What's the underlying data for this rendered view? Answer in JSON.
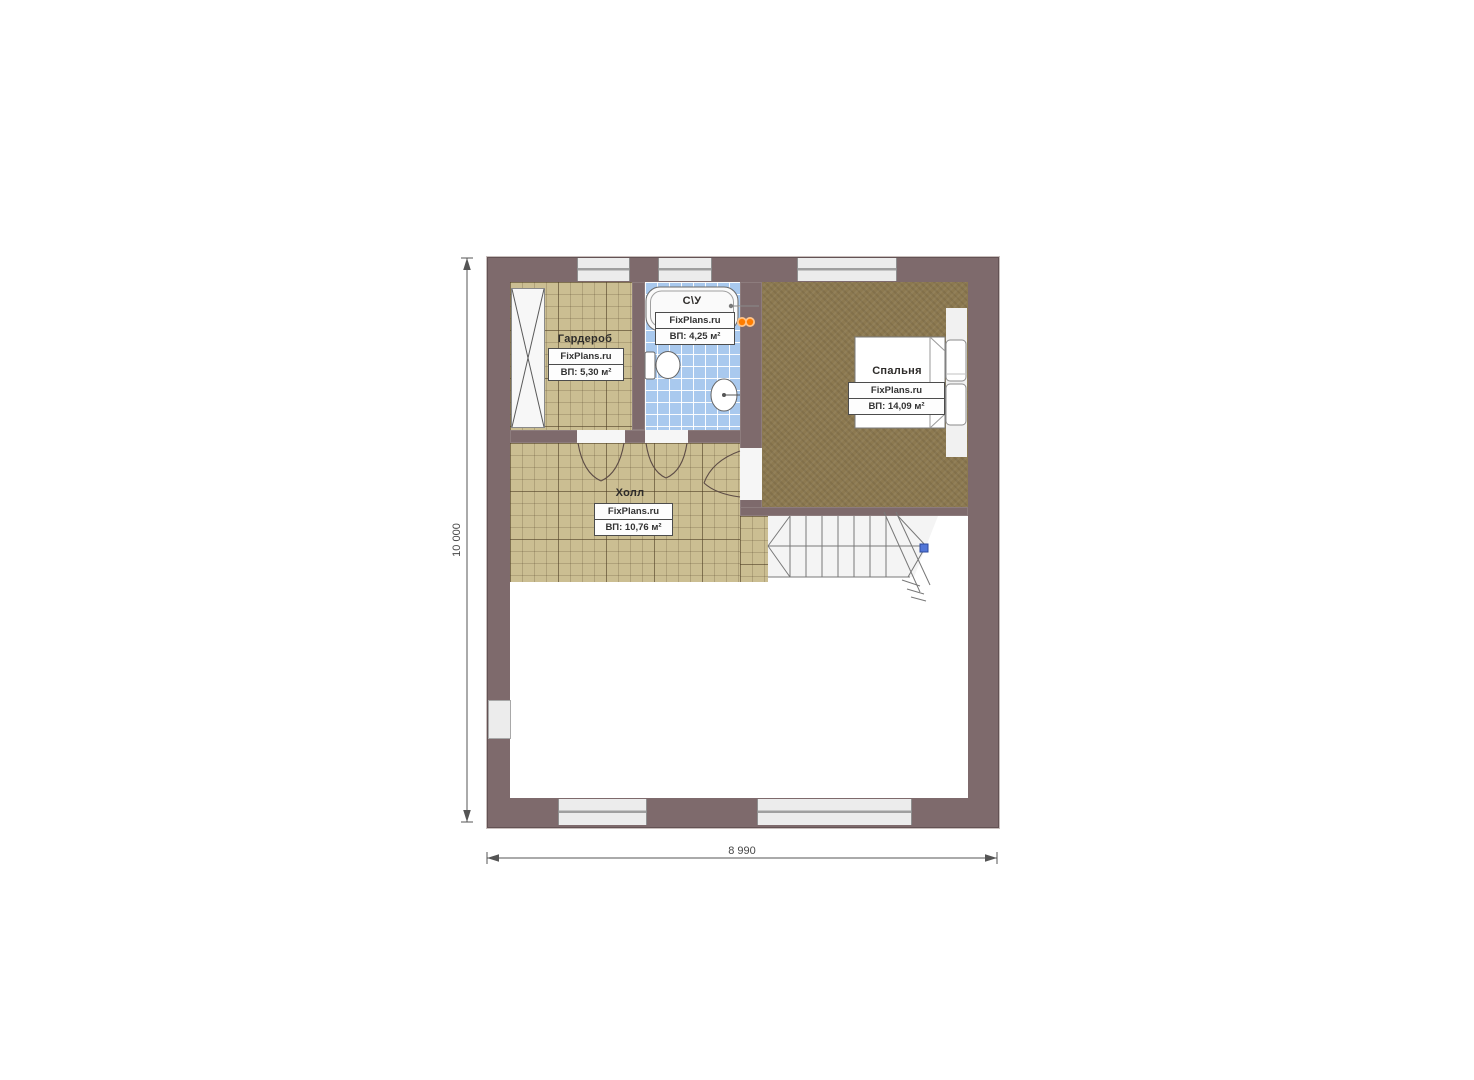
{
  "plan": {
    "rooms": {
      "wardrobe": {
        "name": "Гардероб",
        "watermark": "FixPlans.ru",
        "area": "ВП: 5,30 м²"
      },
      "bathroom": {
        "name": "С\\У",
        "watermark": "FixPlans.ru",
        "area": "ВП: 4,25 м²"
      },
      "bedroom": {
        "name": "Спальня",
        "watermark": "FixPlans.ru",
        "area": "ВП: 14,09 м²"
      },
      "hall": {
        "name": "Холл",
        "watermark": "FixPlans.ru",
        "area": "ВП: 10,76 м²"
      }
    },
    "dimensions": {
      "height_label": "10 000",
      "width_label": "8 990"
    },
    "colors": {
      "wall": "#7e6a6c",
      "tan_floor": "#cbbe92",
      "blue_floor": "#a9c9ee",
      "wood_floor": "#8c7950",
      "towel_dryer_orange": "#ff7d00",
      "stair_marker_blue": "#5276d8"
    }
  }
}
